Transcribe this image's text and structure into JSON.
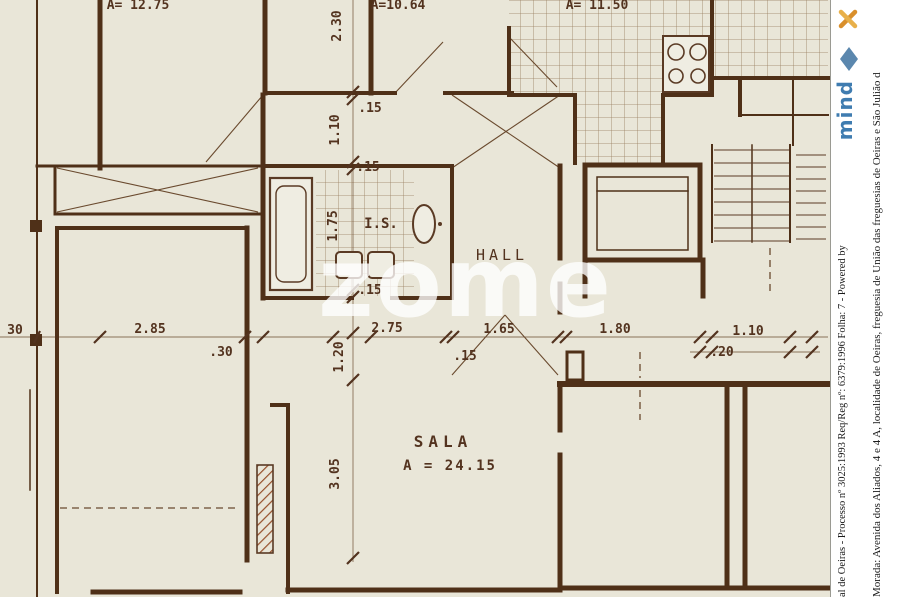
{
  "plan": {
    "watermark": "zome",
    "labels": {
      "room1_area": "A= 12.75",
      "room2_area": "A=10.64",
      "kitchen_area": "A= 11.50",
      "hall": "HALL",
      "is": "I.S.",
      "sala": "SALA",
      "sala_area": "A = 24.15"
    },
    "dims": {
      "v230": "2.30",
      "w15a": ".15",
      "v110": "1.10",
      "w15b": ".15",
      "v175": "1.75",
      "w15c": ".15",
      "left30": "30",
      "h285": "2.85",
      "w30": ".30",
      "v120": "1.20",
      "h275": "2.75",
      "h165": "1.65",
      "w15d": ".15",
      "h180": "1.80",
      "h110": "1.10",
      "w20": ".20",
      "v305": "3.05"
    }
  },
  "sidebar": {
    "process_line": "al de Oeiras - Processo nº 3025:1993 Req/Reg nº: 6379:1996 Folha: 7 - Powered by",
    "address_line": "Morada: Avenida dos Aliados, 4 e 4 A, localidade de Oeiras, freguesia de União das freguesias de Oeiras e São Julião d",
    "logo": "mind",
    "colors": {
      "mind_blue": "#3f7cb0",
      "x_orange": "#d98f2b"
    }
  }
}
